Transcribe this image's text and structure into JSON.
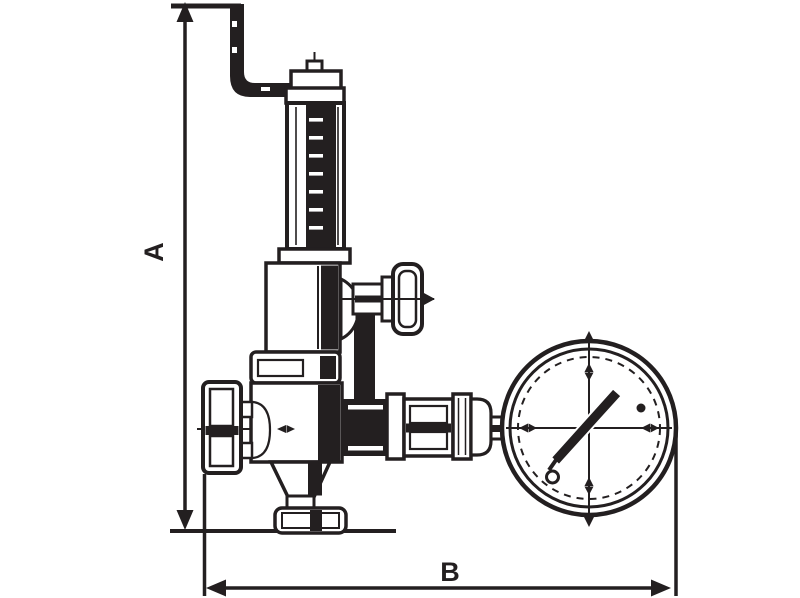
{
  "drawing": {
    "type": "valve-dimensional-drawing",
    "background_color": "#ffffff",
    "ink_color": "#231f20",
    "dimension_a": {
      "label": "A"
    },
    "dimension_b": {
      "label": "B"
    },
    "parts": [
      "adjusting-rod",
      "spring-housing",
      "bonnet",
      "union-nut",
      "valve-body",
      "inlet-union",
      "side-handwheel-valve",
      "outlet-union",
      "pressure-gauge"
    ]
  }
}
